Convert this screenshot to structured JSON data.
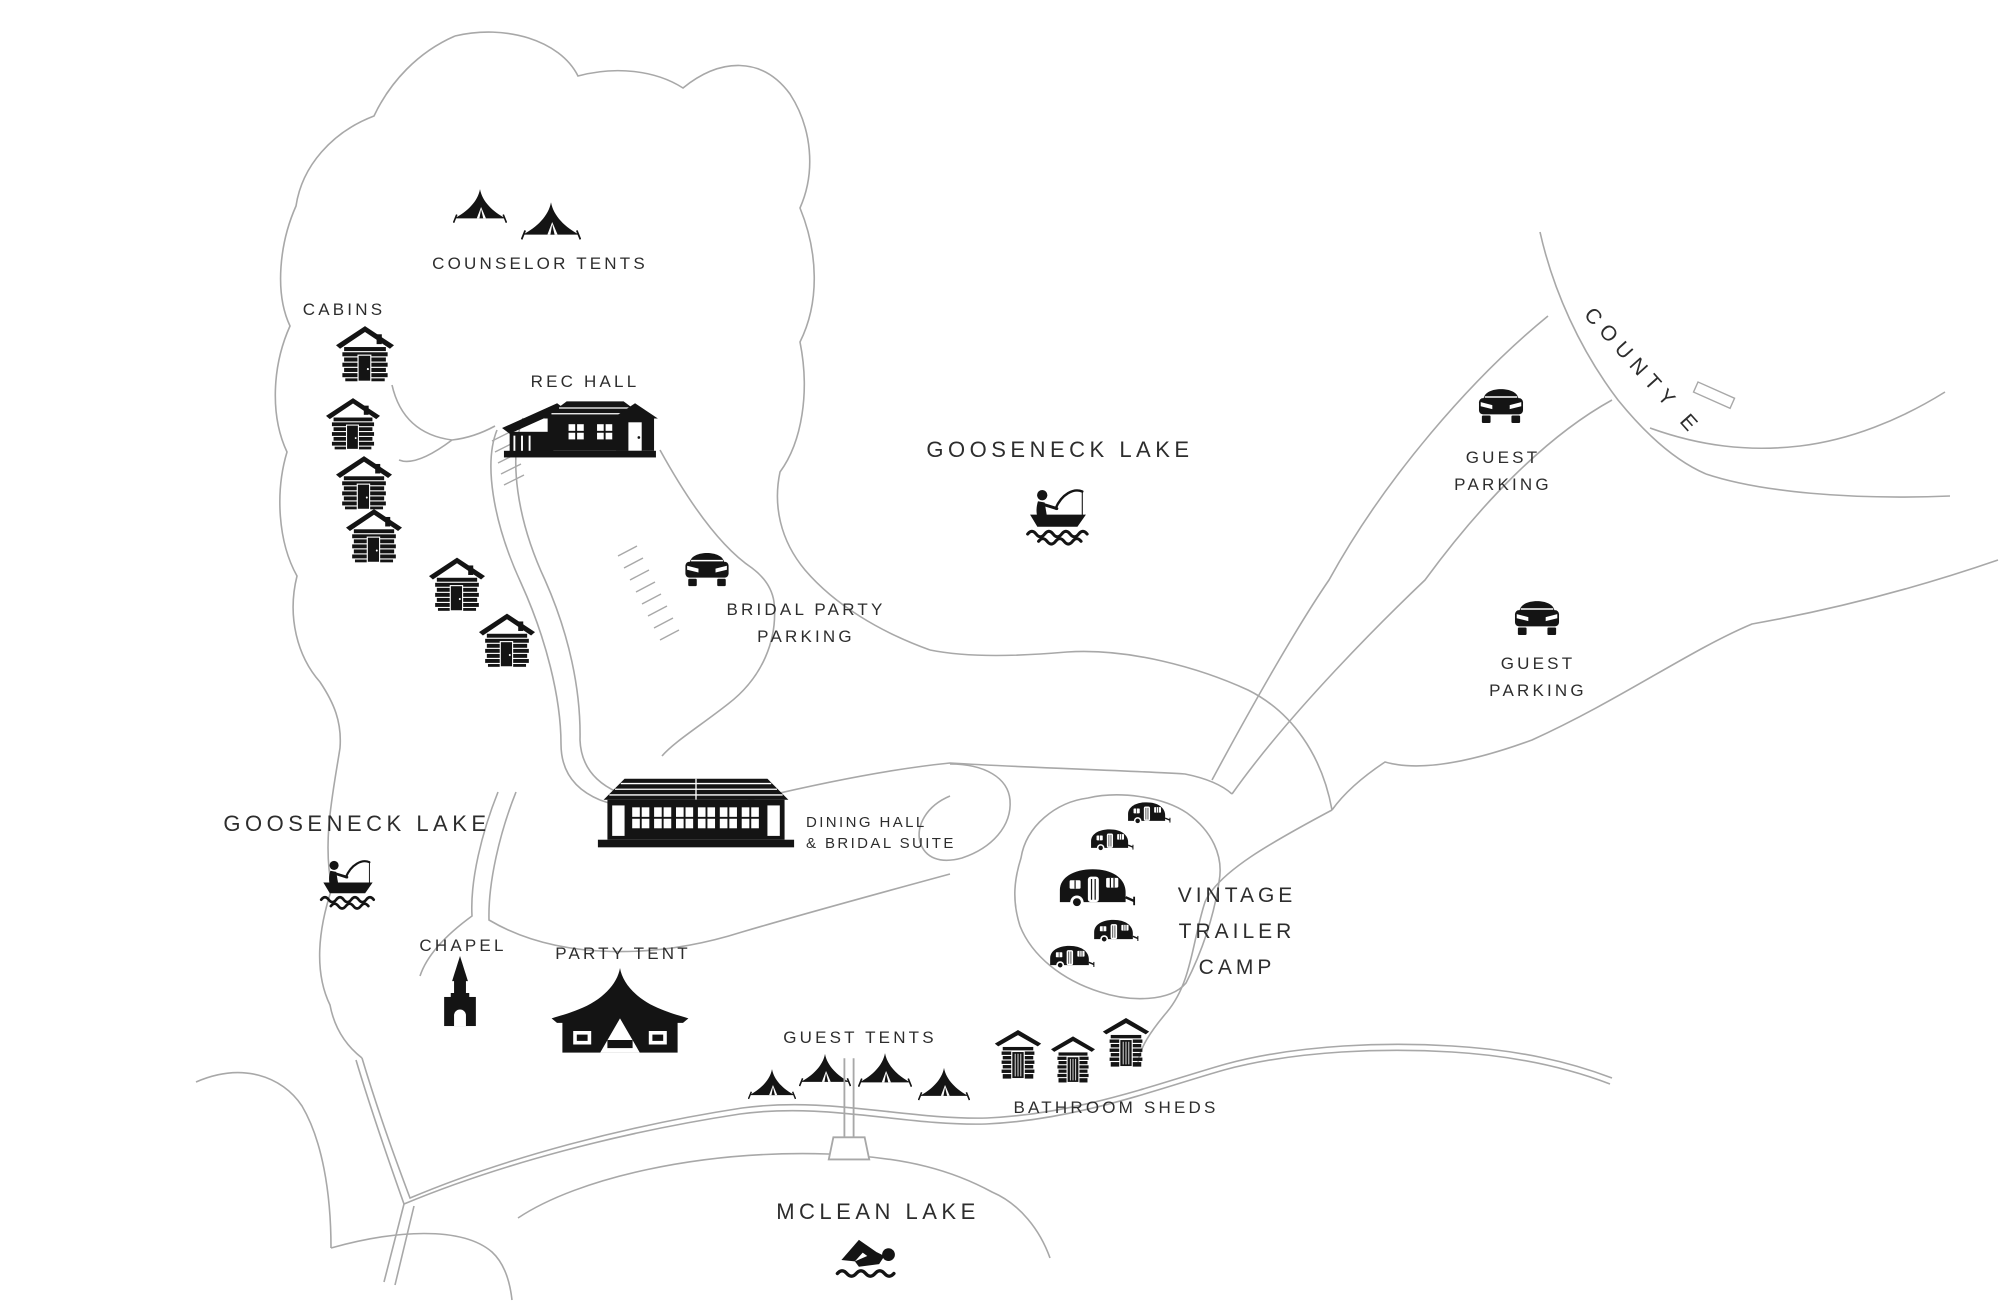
{
  "colors": {
    "background": "#ffffff",
    "ink": "#141414",
    "line": "#a8a8a8",
    "text": "#2d2d2d"
  },
  "labels": {
    "counselor_tents": "COUNSELOR TENTS",
    "cabins": "CABINS",
    "rec_hall": "REC HALL",
    "gooseneck_lake_north": "GOOSENECK LAKE",
    "gooseneck_lake_west": "GOOSENECK LAKE",
    "county_e": "COUNTY E",
    "guest_parking_north": {
      "line1": "GUEST",
      "line2": "PARKING"
    },
    "guest_parking_south": {
      "line1": "GUEST",
      "line2": "PARKING"
    },
    "bridal_party_parking": {
      "line1": "BRIDAL PARTY",
      "line2": "PARKING"
    },
    "dining_hall": {
      "line1": "DINING HALL",
      "line2": "& BRIDAL SUITE"
    },
    "vintage_trailer_camp": {
      "line1": "VINTAGE",
      "line2": "TRAILER",
      "line3": "CAMP"
    },
    "chapel": "CHAPEL",
    "party_tent": "PARTY TENT",
    "guest_tents": "GUEST TENTS",
    "bathroom_sheds": "BATHROOM SHEDS",
    "mclean_lake": "MCLEAN LAKE"
  },
  "icons": {
    "tent-icon": "black bell tent pictogram",
    "cabin-icon": "black log cabin pictogram",
    "rec-hall-icon": "black lodge building pictogram",
    "dining-hall-icon": "black long hall building pictogram",
    "car-icon": "black car front-view pictogram",
    "boat-fisherman-icon": "person fishing from rowboat over waves",
    "swimmer-icon": "person swimming over waves",
    "chapel-icon": "black chapel with steeple and arched door",
    "party-tent-icon": "black marquee tent with swooped peak",
    "trailer-icon": "black vintage camper trailer pictogram",
    "shed-icon": "black gable shed pictogram",
    "dock-icon": "outlined pier/dock shape"
  },
  "counts": {
    "counselor_tents": 2,
    "cabins": 6,
    "guest_tents": 4,
    "bathroom_sheds": 3,
    "trailers": 5,
    "cars": 3,
    "fishing_boats": 2,
    "swimmers": 1
  }
}
